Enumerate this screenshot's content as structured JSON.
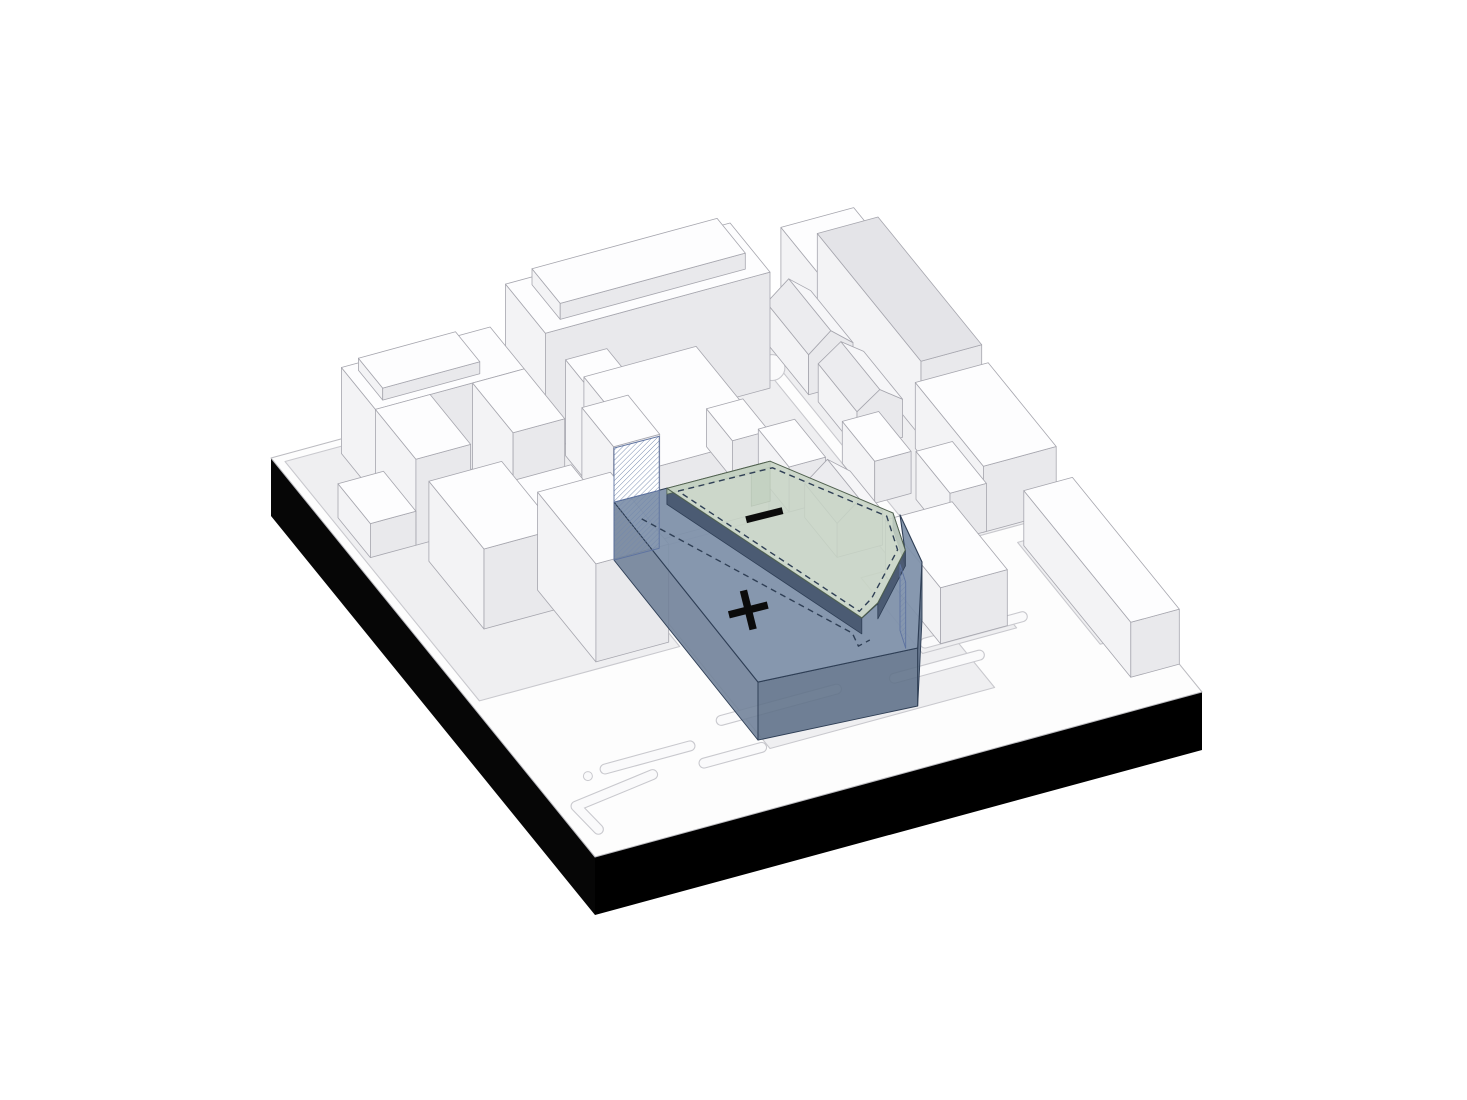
{
  "diagram": {
    "type": "architectural-axonometric-massing",
    "description": "Site massing diagram: blue addition volume (+), green subtraction roof plane (-), white context buildings on black plinth"
  },
  "labels": {
    "plus": "+",
    "minus": "−"
  },
  "colors": {
    "plate": "#fdfdfd",
    "plate_stroke": "#bcbcc1",
    "plinth_left": "#060606",
    "plinth_right": "#000000",
    "sidewalk": "#efeff1",
    "curb": "#c9c9ce",
    "street_fill": "#fafafb",
    "bldg_top": "#fdfdfe",
    "bldg_left": "#f3f3f5",
    "bldg_front": "#e9e9ec",
    "bldg_stroke": "#a6a6ae",
    "roof_plane_near": "#f6f6f8",
    "roof_plane_far": "#ececef",
    "slab_gray": "#e4e4e8",
    "massing_top": "#7e90a9",
    "massing_side_w": "#6e8097",
    "massing_side_s": "#5d6f88",
    "massing_side_e": "#54667f",
    "massing_stroke": "#2e3e55",
    "under_edge": "#46566e",
    "roof_top": "#c7d4c5",
    "roof_edge": "#b2c4b1",
    "roof_fin": "#aabfa9",
    "roof_stroke": "#50614f",
    "hatch_line": "#7388ad",
    "hatch_stroke": "#5e73a0",
    "dash": "#2f3f55",
    "label": "#0b0b0b"
  },
  "scene": {
    "origin": [
      271,
      458
    ],
    "e1": [
      607,
      -165
    ],
    "e2": [
      324,
      399
    ],
    "plinth_height": 58,
    "sidewalks": [
      [
        [
          0.015,
          0.015
        ],
        [
          0.345,
          0.015
        ],
        [
          0.345,
          0.615
        ],
        [
          0.015,
          0.615
        ]
      ],
      [
        [
          0.375,
          0.005
        ],
        [
          0.765,
          0.005
        ],
        [
          0.765,
          0.4
        ],
        [
          0.375,
          0.4
        ]
      ],
      [
        [
          0.355,
          0.4
        ],
        [
          0.725,
          0.4
        ],
        [
          0.725,
          0.875
        ],
        [
          0.355,
          0.875
        ]
      ],
      [
        [
          0.785,
          0.005
        ],
        [
          1.0,
          0.005
        ],
        [
          1.0,
          0.555
        ],
        [
          0.785,
          0.555
        ]
      ],
      [
        [
          0.665,
          0.575
        ],
        [
          0.82,
          0.575
        ],
        [
          0.82,
          0.765
        ],
        [
          0.665,
          0.765
        ]
      ],
      [
        [
          0.915,
          0.59
        ],
        [
          1.0,
          0.59
        ],
        [
          1.0,
          0.845
        ],
        [
          0.915,
          0.845
        ]
      ]
    ],
    "street_bulge": {
      "c": [
        0.775,
        0.094
      ],
      "r": 13
    },
    "small_circle": {
      "c": [
        0.079,
        0.83
      ],
      "r": 4.5
    },
    "pills": [
      [
        [
          0.11,
          0.825
        ],
        [
          0.25,
          0.825
        ]
      ],
      [
        [
          0.32,
          0.79
        ],
        [
          0.51,
          0.79
        ]
      ],
      [
        [
          0.25,
          0.868
        ],
        [
          0.345,
          0.868
        ]
      ],
      [
        [
          0.6,
          0.8
        ],
        [
          0.74,
          0.8
        ]
      ],
      [
        [
          0.68,
          0.745
        ],
        [
          0.84,
          0.745
        ]
      ],
      [
        [
          0.035,
          0.945
        ],
        [
          0.03,
          0.885
        ],
        [
          0.168,
          0.863
        ]
      ]
    ],
    "buildings": [
      {
        "t": "box",
        "r": [
          0.84,
          0.0,
          0.96,
          0.12
        ],
        "h": 92
      },
      {
        "t": "box",
        "r": [
          0.9,
          0.0,
          1.0,
          0.32
        ],
        "h": 76,
        "top": "slab_gray"
      },
      {
        "t": "gable",
        "r": [
          0.795,
          0.04,
          0.868,
          0.17
        ],
        "h": 40,
        "hr": 58
      },
      {
        "t": "gable",
        "r": [
          0.8,
          0.19,
          0.875,
          0.31
        ],
        "h": 38,
        "hr": 54
      },
      {
        "t": "box",
        "r": [
          0.765,
          0.33,
          0.825,
          0.43
        ],
        "h": 42
      },
      {
        "t": "box",
        "r": [
          0.88,
          0.34,
          1.0,
          0.55
        ],
        "h": 66
      },
      {
        "t": "box",
        "r": [
          0.825,
          0.445,
          0.885,
          0.55
        ],
        "h": 48
      },
      {
        "t": "box",
        "r": [
          0.92,
          0.6,
          1.0,
          0.93
        ],
        "h": 55
      },
      {
        "t": "box",
        "r": [
          0.7,
          0.585,
          0.81,
          0.755
        ],
        "h": 56
      },
      {
        "t": "box",
        "r": [
          0.38,
          0.012,
          0.75,
          0.135
        ],
        "h": 116
      },
      {
        "t": "box",
        "r": [
          0.415,
          0.028,
          0.72,
          0.115
        ],
        "h": 132,
        "zb": 116
      },
      {
        "t": "box",
        "r": [
          0.4,
          0.16,
          0.468,
          0.38
        ],
        "h": 96
      },
      {
        "t": "box",
        "r": [
          0.43,
          0.16,
          0.615,
          0.385
        ],
        "h": 74
      },
      {
        "t": "box",
        "r": [
          0.352,
          0.3,
          0.428,
          0.398
        ],
        "h": 112
      },
      {
        "t": "box",
        "r": [
          0.6,
          0.22,
          0.66,
          0.3
        ],
        "h": 38
      },
      {
        "t": "box",
        "r": [
          0.64,
          0.305,
          0.7,
          0.4
        ],
        "h": 45
      },
      {
        "t": "gable",
        "r": [
          0.655,
          0.42,
          0.73,
          0.52
        ],
        "h": 34,
        "hr": 52
      },
      {
        "t": "box",
        "r": [
          0.1,
          0.03,
          0.345,
          0.135
        ],
        "h": 86
      },
      {
        "t": "box",
        "r": [
          0.12,
          0.045,
          0.28,
          0.12
        ],
        "h": 98,
        "zb": 86
      },
      {
        "t": "box",
        "r": [
          0.1,
          0.135,
          0.19,
          0.26
        ],
        "h": 86
      },
      {
        "t": "box",
        "r": [
          0.26,
          0.135,
          0.345,
          0.26
        ],
        "h": 86
      },
      {
        "t": "box",
        "r": [
          0.025,
          0.16,
          0.1,
          0.26
        ],
        "h": 34
      },
      {
        "t": "box",
        "r": [
          0.23,
          0.28,
          0.345,
          0.385
        ],
        "h": 48
      },
      {
        "t": "box",
        "r": [
          0.1,
          0.3,
          0.22,
          0.47
        ],
        "h": 80
      },
      {
        "t": "box",
        "r": [
          0.215,
          0.42,
          0.335,
          0.6
        ],
        "h": 98
      }
    ],
    "site": {
      "blue_z": 58,
      "green_z": 74,
      "blue_top": [
        [
          0.351,
          0.401
        ],
        [
          0.438,
          0.402
        ],
        [
          0.559,
          0.777
        ],
        [
          0.597,
          0.756
        ],
        [
          0.691,
          0.662
        ],
        [
          0.723,
          0.587
        ],
        [
          0.701,
          0.696
        ],
        [
          0.601,
          0.87
        ],
        [
          0.348,
          0.851
        ]
      ],
      "blue_faces": [
        {
          "e": [
            [
              0.351,
              0.401
            ],
            [
              0.348,
              0.851
            ]
          ],
          "fill": "massing_side_w"
        },
        {
          "e": [
            [
              0.348,
              0.851
            ],
            [
              0.601,
              0.87
            ]
          ],
          "fill": "massing_side_s"
        },
        {
          "e": [
            [
              0.701,
              0.696
            ],
            [
              0.601,
              0.87
            ]
          ],
          "fill": "massing_side_e"
        }
      ],
      "green_top": [
        [
          0.42,
          0.435
        ],
        [
          0.589,
          0.437
        ],
        [
          0.698,
          0.612
        ],
        [
          0.674,
          0.695
        ],
        [
          0.579,
          0.788
        ],
        [
          0.541,
          0.81
        ]
      ],
      "green_north_edge": [
        [
          0.42,
          0.435
        ],
        [
          0.589,
          0.437
        ]
      ],
      "green_fin": [
        [
          0.558,
          0.437
        ],
        [
          0.589,
          0.437
        ]
      ],
      "under_strips": [
        [
          [
            0.42,
            0.435
          ],
          [
            0.541,
            0.81
          ]
        ],
        [
          [
            0.698,
            0.612
          ],
          [
            0.674,
            0.695
          ]
        ],
        [
          [
            0.674,
            0.695
          ],
          [
            0.579,
            0.788
          ]
        ]
      ],
      "hatch_nw_edge": [
        [
          0.351,
          0.401
        ],
        [
          0.425,
          0.402
        ]
      ],
      "hatch_nw_top": 112,
      "hatch_e_edge": [
        [
          0.66,
          0.705
        ],
        [
          0.648,
          0.745
        ]
      ],
      "hatch_e_top": 66,
      "dashed_blue": [
        [
          0.37,
          0.451
        ],
        [
          0.529,
          0.803
        ],
        [
          0.523,
          0.833
        ],
        [
          0.545,
          0.827
        ]
      ],
      "dashed_green": [
        [
          0.432,
          0.447
        ],
        [
          0.585,
          0.452
        ],
        [
          0.686,
          0.615
        ],
        [
          0.664,
          0.69
        ],
        [
          0.576,
          0.775
        ],
        [
          0.545,
          0.795
        ]
      ]
    }
  }
}
